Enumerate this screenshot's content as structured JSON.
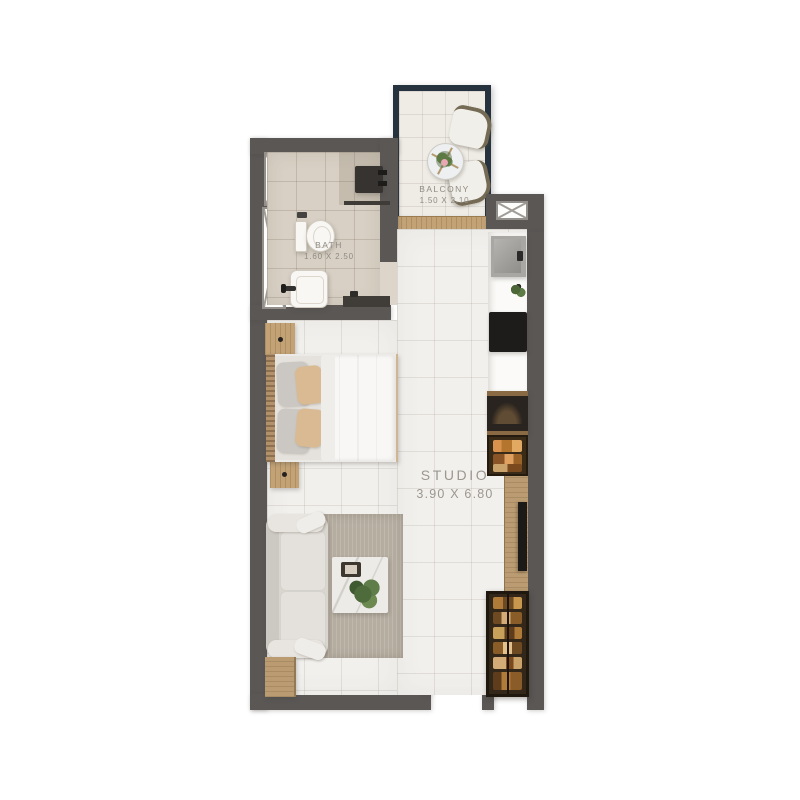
{
  "rooms": {
    "balcony": {
      "name": "BALCONY",
      "dims": "1.50 X 2.10"
    },
    "bath": {
      "name": "BATH",
      "dims": "1.60 X 2.50"
    },
    "studio": {
      "name": "STUDIO",
      "dims": "3.90 X 6.80"
    }
  },
  "colors": {
    "wall": "#5a5755",
    "balcony_railing": "#26333e",
    "studio_floor": "#f2f0ed",
    "bath_floor": "#d8d0c4",
    "balcony_floor": "#efece6",
    "wood": "#c3a376",
    "cooktop_black": "#1e1c1a",
    "rug_taupe": "#b6ada1",
    "pillow_tan": "#d9ba92",
    "wardrobe_brown": "#33271a",
    "shelf_amber": "#b07a38",
    "label_text": "#8f8b83"
  },
  "fixtures": [
    "balcony-chairs",
    "balcony-round-table",
    "sliding-door-sill",
    "duct-shafts",
    "shower",
    "toilet",
    "bathroom-sink",
    "vanity-shelf",
    "kitchen-sink",
    "cooktop",
    "oven",
    "pantry-shelf",
    "tv-console",
    "tv",
    "wardrobe",
    "double-bed",
    "nightstands",
    "sofa",
    "rug",
    "coffee-table",
    "side-table",
    "entry-door-opening"
  ]
}
